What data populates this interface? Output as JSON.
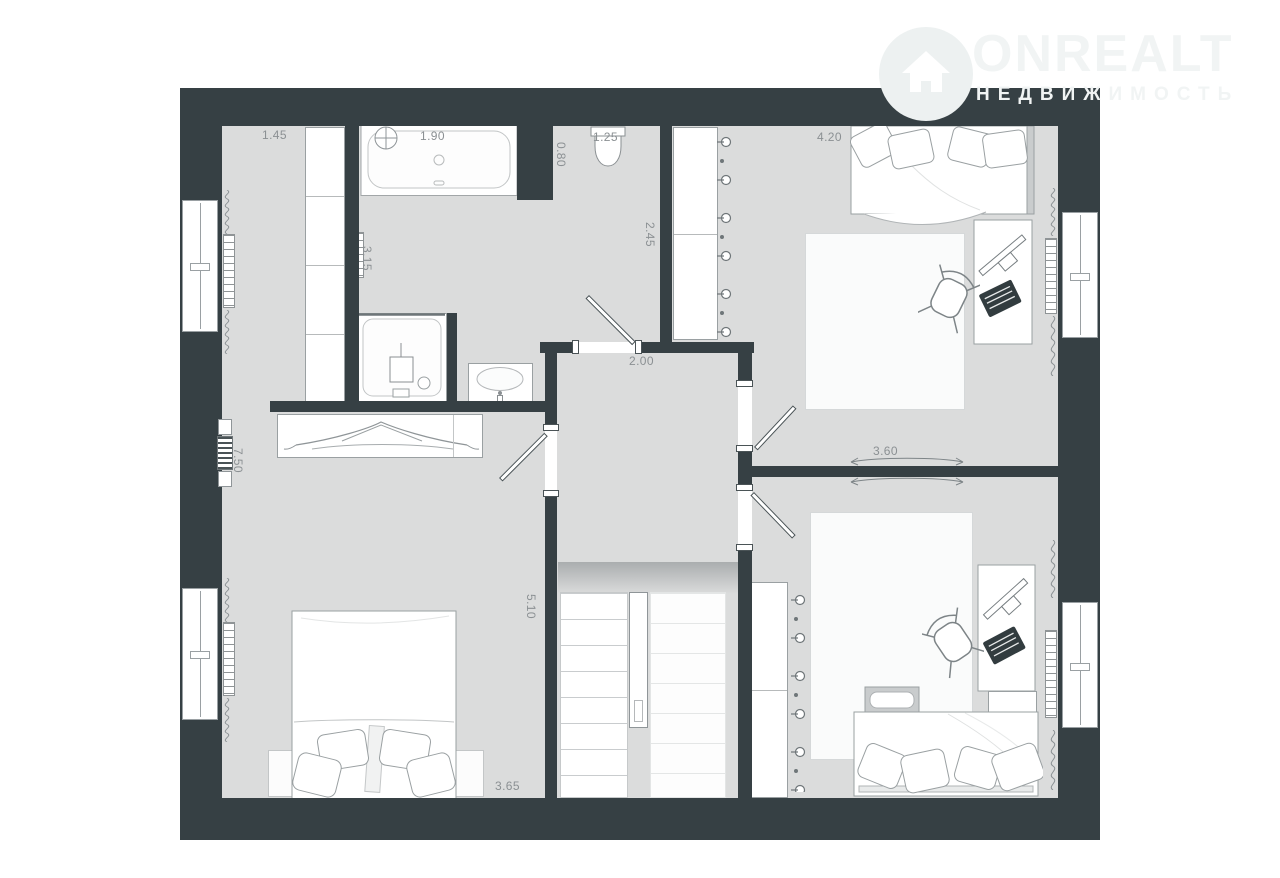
{
  "theme": {
    "wall": "#364044",
    "floor": "#dbdcdc",
    "dim": "#8b9093",
    "logo": "#f1f4f4",
    "line": "#9aa0a2"
  },
  "logo": {
    "brand": "ONREALT",
    "tagline": "НЕДВИЖИМОСТЬ",
    "icon": "house-in-circle-icon"
  },
  "plan": {
    "dims": {
      "d145": "1.45",
      "d190": "1.90",
      "d125": "1.25",
      "d080": "0.80",
      "d245": "2.45",
      "d420": "4.20",
      "d315": "3.15",
      "d200": "2.00",
      "d360": "3.60",
      "d750": "7.50",
      "d510": "5.10",
      "d365": "3.65"
    },
    "symbols": [
      "bathtub",
      "toilet",
      "shower",
      "washbasin",
      "towel-radiator",
      "double-bed",
      "single-bed",
      "pillow",
      "wardrobe",
      "clothes-hanger",
      "console-table",
      "desk",
      "monitor",
      "keyboard",
      "office-chair",
      "rug",
      "stairs",
      "door-swing",
      "window",
      "radiator",
      "curtain",
      "vent"
    ]
  }
}
